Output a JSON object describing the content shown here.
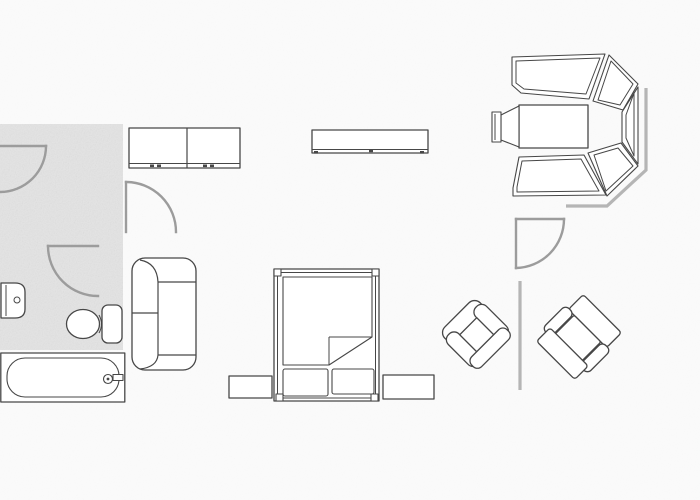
{
  "meta": {
    "kind": "scanned-furniture-floor-plan",
    "canvas": {
      "width": 700,
      "height": 500
    },
    "visible_text": "none"
  },
  "palette": {
    "background": "#fbfbfb",
    "floor_shade": "#e4e4e4",
    "furniture_line": "#474747",
    "door_line": "#9c9c9c",
    "wall_line": "#b5b5b5",
    "fill": "#ffffff"
  },
  "rooms": [
    {
      "id": "bathroom",
      "description": "shaded gray floor area, top-left",
      "bounds_px": [
        0,
        124,
        123,
        350
      ]
    }
  ],
  "doors": [
    {
      "id": "door-top-left",
      "hinge_px": [
        0,
        146
      ],
      "radius_px": 46,
      "swing": "opens into bathroom from left wall"
    },
    {
      "id": "door-bathroom-lower",
      "hinge_px": [
        98,
        246
      ],
      "radius_px": 50,
      "swing": "opens down-left inside bathroom"
    },
    {
      "id": "door-hall-middle",
      "hinge_px": [
        126,
        232
      ],
      "radius_px": 50,
      "swing": "opens up-right beside wardrobe"
    },
    {
      "id": "door-bedroom-right",
      "hinge_px": [
        516,
        219
      ],
      "radius_px": 49,
      "swing": "opens down-right below bay window"
    }
  ],
  "walls": [
    {
      "id": "bay-corner-wall",
      "points_px": [
        [
          646,
          88
        ],
        [
          646,
          170
        ],
        [
          607,
          206
        ],
        [
          566,
          206
        ]
      ]
    },
    {
      "id": "wall-between-armchairs",
      "points_px": [
        [
          520,
          281
        ],
        [
          520,
          390
        ]
      ]
    }
  ],
  "furniture": [
    {
      "id": "two-door-wardrobe",
      "bounds_px": [
        129,
        128,
        240,
        168
      ]
    },
    {
      "id": "sideboard-shelf",
      "bounds_px": [
        312,
        130,
        428,
        153
      ]
    },
    {
      "id": "wash-basin",
      "bounds_px": [
        0,
        283,
        25,
        318
      ]
    },
    {
      "id": "toilet",
      "bounds_px": [
        67,
        305,
        122,
        343
      ]
    },
    {
      "id": "bathtub",
      "bounds_px": [
        0,
        353,
        125,
        402
      ]
    },
    {
      "id": "two-seat-sofa",
      "bounds_px": [
        132,
        258,
        196,
        370
      ],
      "facing": "right"
    },
    {
      "id": "double-bed",
      "bounds_px": [
        274,
        269,
        379,
        402
      ],
      "details": [
        "corner posts",
        "turned-down sheet corner",
        "two pillows at foot"
      ]
    },
    {
      "id": "nightstand-left",
      "bounds_px": [
        229,
        376,
        272,
        398
      ]
    },
    {
      "id": "nightstand-right",
      "bounds_px": [
        383,
        375,
        434,
        399
      ]
    },
    {
      "id": "armchair-left",
      "bounds_px": [
        443,
        300,
        510,
        368
      ],
      "rotation_deg": -45
    },
    {
      "id": "armchair-right",
      "bounds_px": [
        535,
        292,
        623,
        383
      ],
      "rotation_deg": 45
    },
    {
      "id": "bay-window-seating-group",
      "bounds_px": [
        492,
        53,
        638,
        197
      ],
      "parts": [
        "top bench",
        "upper corner segment",
        "right segment",
        "lower corner segment",
        "bottom bench",
        "center table",
        "side chair"
      ]
    }
  ]
}
